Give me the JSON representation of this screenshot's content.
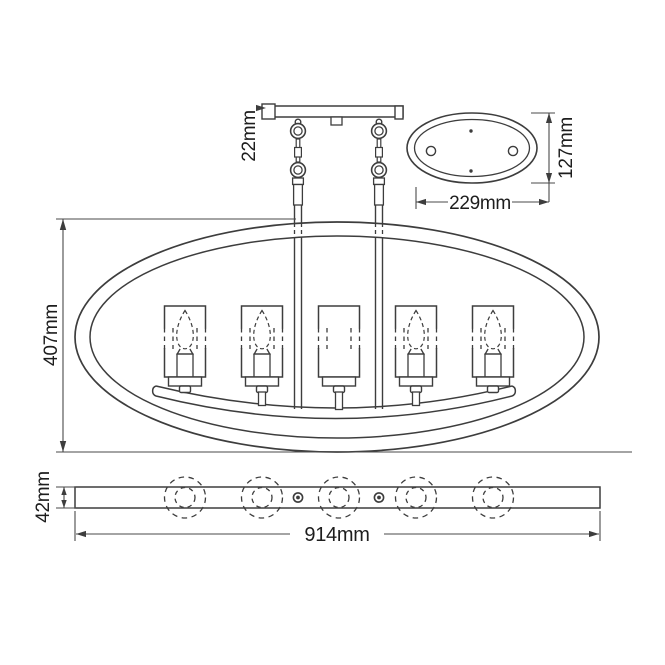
{
  "diagram": {
    "kind": "chandelier dimension line drawing",
    "views": [
      "front elevation",
      "canopy top view",
      "fixture bottom view"
    ],
    "lights_count": 5,
    "background_color": "#ffffff",
    "line_color": "#3d3d3d",
    "dim_line_color": "#4a4a4a",
    "text_color": "#1d1d1d"
  },
  "dims": {
    "plate_thickness": {
      "label": "22mm"
    },
    "canopy_width": {
      "label": "229mm"
    },
    "canopy_height": {
      "label": "127mm"
    },
    "body_height": {
      "label": "407mm"
    },
    "bar_thickness": {
      "label": "42mm"
    },
    "overall_width": {
      "label": "914mm"
    }
  }
}
